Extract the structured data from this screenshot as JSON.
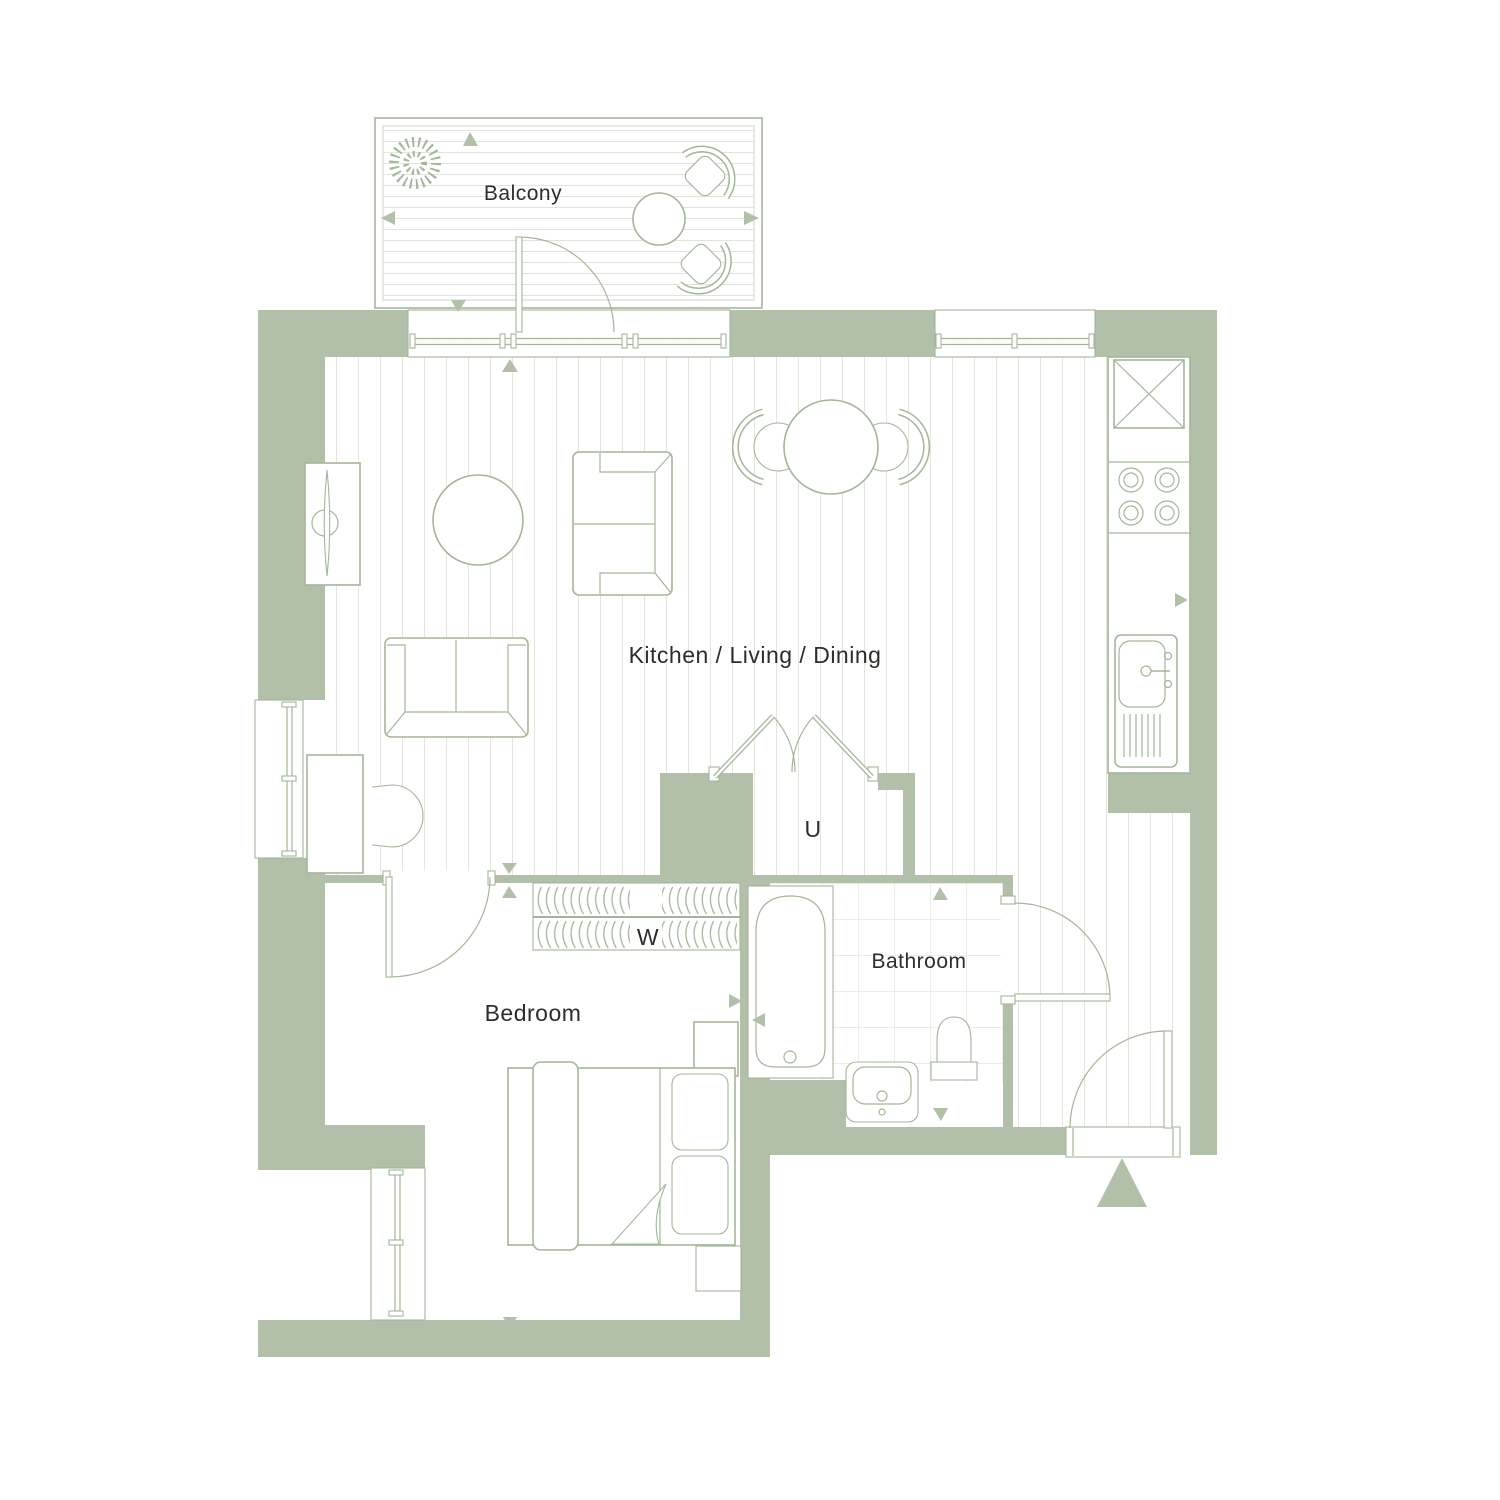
{
  "labels": {
    "balcony": "Balcony",
    "kitchen_living_dining": "Kitchen / Living / Dining",
    "utility": "U",
    "wardrobe": "W",
    "bedroom": "Bedroom",
    "bathroom": "Bathroom"
  },
  "colors": {
    "wall": "#b3c0a9",
    "furniture_line": "#a4b69a",
    "floor_line": "#d7dccf",
    "tile_line": "#dde1d5",
    "text": "#2d2d2a",
    "background": "#ffffff"
  },
  "icons": {
    "entrance_arrow": "solid-triangle-up",
    "dimension_marker": "small-solid-triangle",
    "plant": "dashed-circle-shrub",
    "fridge": "crossed-box",
    "hob": "four-burner-circles"
  }
}
